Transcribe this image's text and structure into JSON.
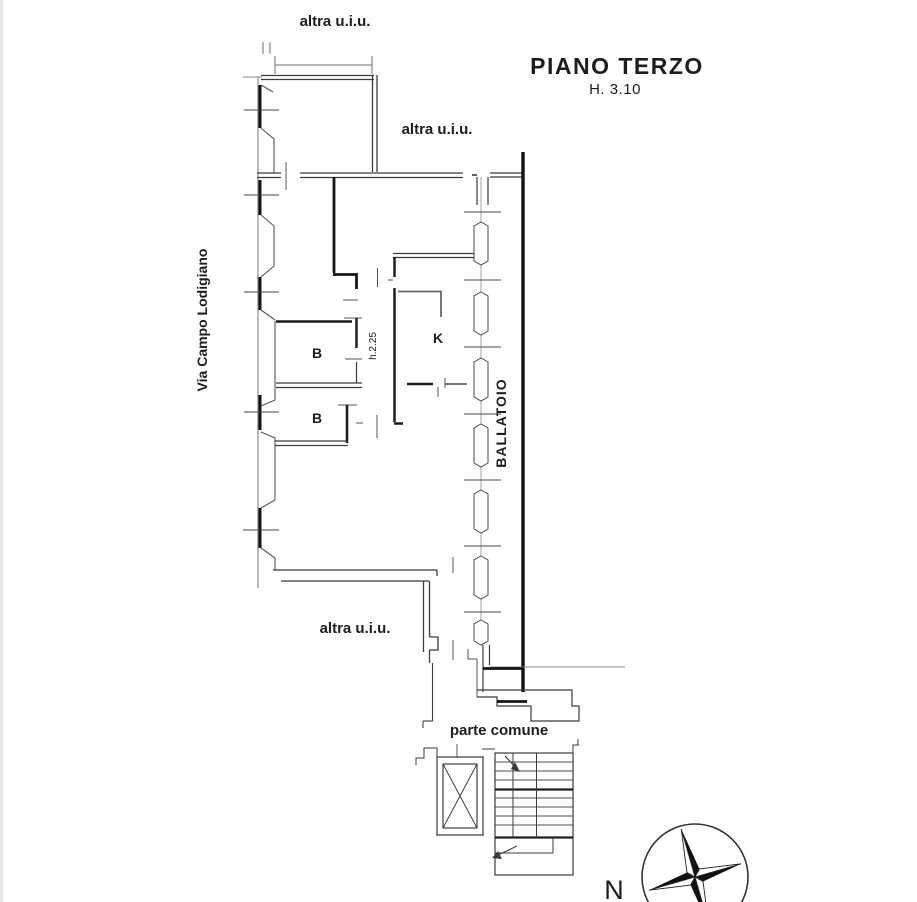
{
  "title": {
    "main": "PIANO TERZO",
    "height_note": "H. 3.10"
  },
  "floor_plan": {
    "street_label": "Via Campo Lodigiano",
    "other_units": [
      "altra u.i.u.",
      "altra u.i.u.",
      "altra u.i.u."
    ],
    "rooms": {
      "bath_1": "B",
      "bath_2": "B",
      "kitchen": "K"
    },
    "ceiling_height_note": "h.2.25",
    "gallery_label": "BALLATOIO",
    "common_area_label": "parte comune"
  },
  "compass": {
    "north_label": "N"
  },
  "colors": {
    "background": "#ffffff",
    "wall_dark": "#141414",
    "wall_medium": "#3b3b3b",
    "wall_light": "#8a8a8a"
  }
}
